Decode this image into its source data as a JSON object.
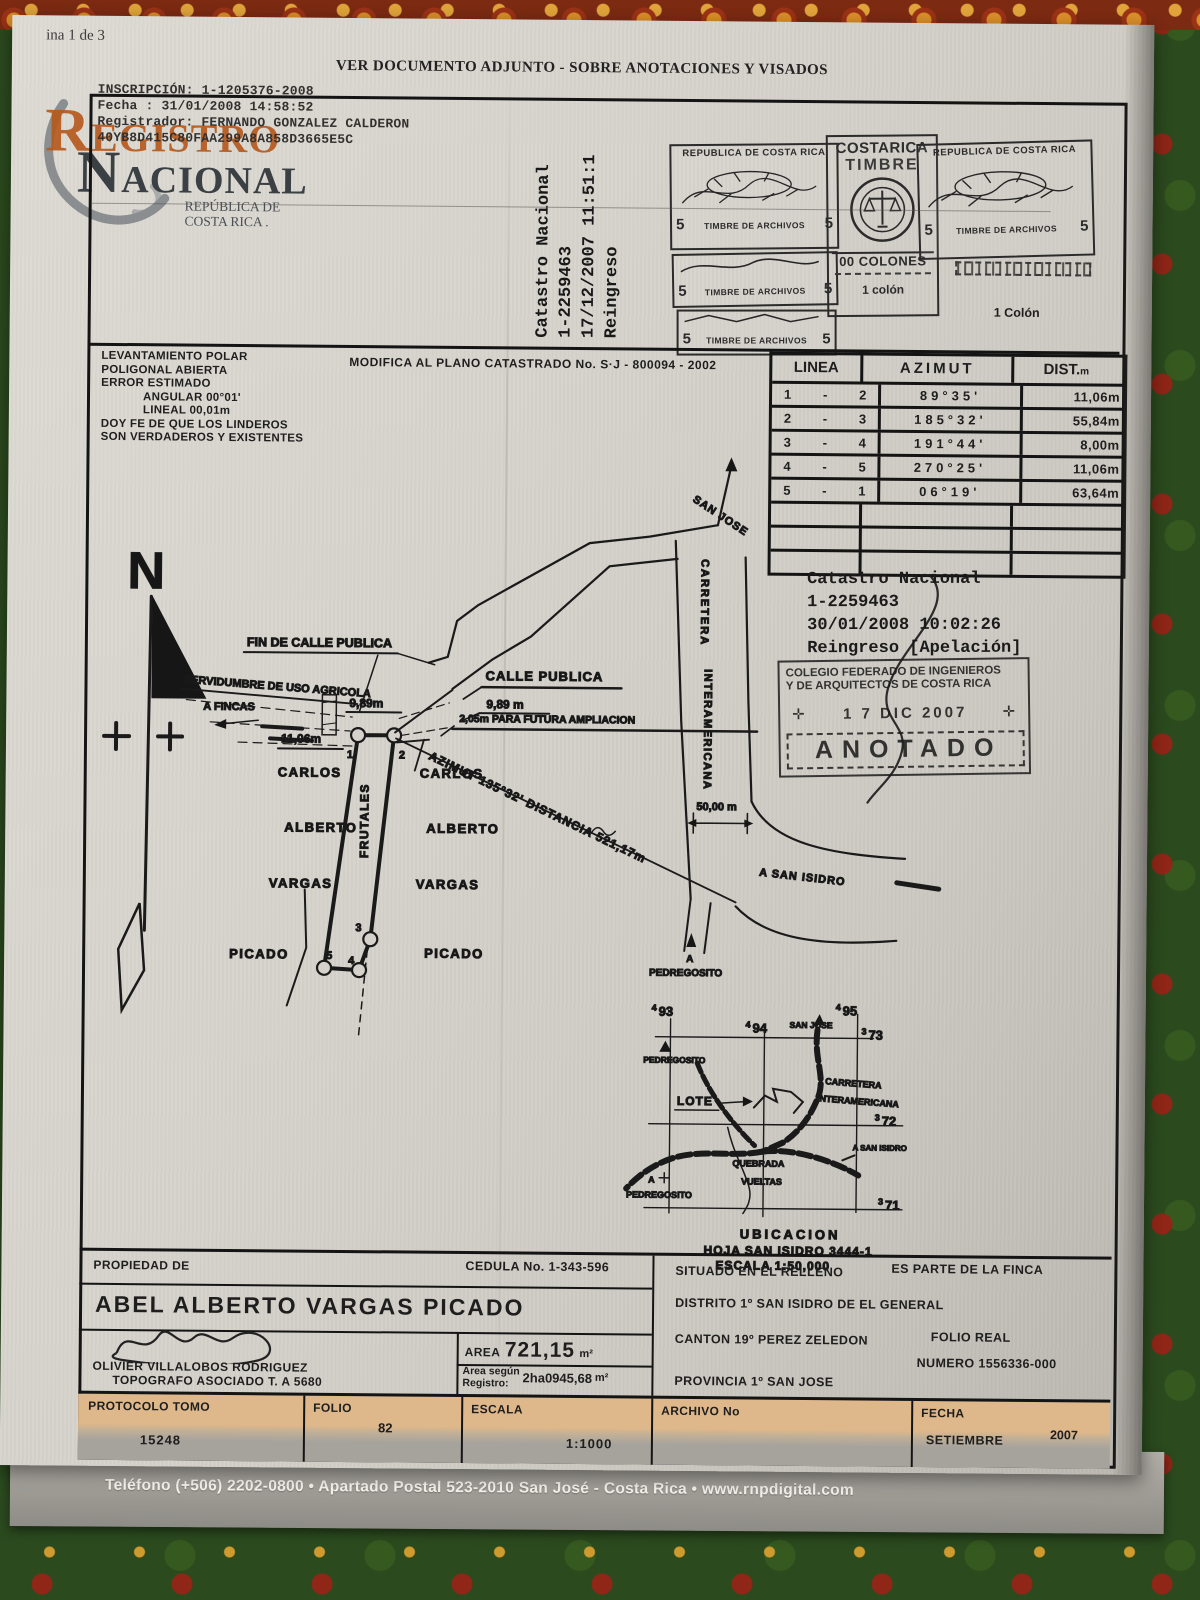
{
  "page": {
    "page_indicator": "ina 1 de 3",
    "header_title": "VER DOCUMENTO ADJUNTO - SOBRE ANOTACIONES Y VISADOS",
    "footer": "Teléfono (+506) 2202-0800 • Apartado Postal 523-2010 San José - Costa Rica • www.rnpdigital.com"
  },
  "inscription": {
    "line1": "INSCRIPCIÓN: 1-1205376-2008",
    "line2": "Fecha :  31/01/2008 14:58:52",
    "line3": "Registrador: FERNANDO GONZALEZ CALDERON",
    "line4": "40YB8D415C80FAA299A8A858D3665E5C"
  },
  "logo": {
    "registro": "REGISTRO",
    "nacional": "NACIONAL",
    "republica": "REPÚBLICA DE",
    "costa_rica": "COSTA RICA ."
  },
  "reingreso_vertical": {
    "line1": "Catastro Nacional",
    "line2": "1-2259463",
    "line3": "17/12/2007 11:51:1",
    "line4": "Reingreso"
  },
  "timbres": {
    "republica": "REPUBLICA DE COSTA RICA",
    "valor": "5",
    "timbre_archivos": "TIMBRE DE ARCHIVOS",
    "costarica": "COSTARICA",
    "timbre": "TIMBRE",
    "colones": "00 COLONES",
    "colon_small": "1 colón",
    "colon_cap": "1 Colón"
  },
  "notes": {
    "line1": "LEVANTAMIENTO  POLAR",
    "line2": "POLIGONAL  ABIERTA",
    "line3": "ERROR ESTIMADO",
    "line4": "ANGULAR 00°01'",
    "line5": "LINEAL    00,01m",
    "line6": "DOY FE DE QUE LOS LINDEROS",
    "line7": "SON VERDADEROS Y EXISTENTES"
  },
  "modifica": {
    "text": "MODIFICA AL PLANO CATASTRADO No. S·J - 800094 - 2002"
  },
  "table": {
    "col_linea": "LINEA",
    "col_azimut": "AZIMUT",
    "col_dist": "DIST.",
    "col_dist_unit": "m",
    "dash": "-",
    "rows": [
      {
        "from": "1",
        "to": "2",
        "azimut": "89°35'",
        "dist": "11,06m"
      },
      {
        "from": "2",
        "to": "3",
        "azimut": "185°32'",
        "dist": "55,84m"
      },
      {
        "from": "3",
        "to": "4",
        "azimut": "191°44'",
        "dist": "8,00m"
      },
      {
        "from": "4",
        "to": "5",
        "azimut": "270°25'",
        "dist": "11,06m"
      },
      {
        "from": "5",
        "to": "1",
        "azimut": "06°19'",
        "dist": "63,64m"
      }
    ]
  },
  "catastro_stamp": {
    "line1": "Catastro Nacional",
    "line2": "1-2259463",
    "line3": "30/01/2008 10:02:26",
    "line4": "Reingreso [Apelación]"
  },
  "anotado": {
    "line1": "COLEGIO FEDERADO DE INGENIEROS",
    "line2": "Y DE ARQUITECTOS DE COSTA RICA",
    "cross": "✛",
    "date": "1 7  DIC  2007",
    "word": "ANOTADO"
  },
  "drawing": {
    "north": "N",
    "fin_calle": "FIN DE CALLE PUBLICA",
    "servidumbre": "SERVIDUMBRE DE USO AGRICOLA",
    "a_fincas": "A FINCAS",
    "dim_989_left": "9,89m",
    "dim_1106": "11,06m",
    "calle_publica": "CALLE PUBLICA",
    "dim_989_right": "9,89 m",
    "ampliacion": "2,05m PARA FUTURA AMPLIACION",
    "azimut_label": "AZIMUT 135°32' DISTANCIA   521,17m",
    "frutales": "FRUTALES",
    "neighbor_left": [
      "CARLOS",
      "ALBERTO",
      "VARGAS",
      "PICADO"
    ],
    "neighbor_right": [
      "CARLOS",
      "ALBERTO",
      "VARGAS",
      "PICADO"
    ],
    "points": [
      "1",
      "2",
      "3",
      "4",
      "5"
    ],
    "san_jose": "SAN JOSE",
    "carretera": "CARRETERA",
    "interamericana": "INTERAMERICANA",
    "dim_50": "50,00 m",
    "a_san_isidro": "A SAN ISIDRO",
    "a": "A",
    "pedregosito": "PEDREGOSITO"
  },
  "map": {
    "g93p": "4",
    "g93": "93",
    "g94p": "4",
    "g94": "94",
    "g95p": "4",
    "g95": "95",
    "g73p": "3",
    "g73": "73",
    "g72p": "3",
    "g72": "72",
    "g71p": "3",
    "g71": "71",
    "pedregosito": "PEDREGOSITO",
    "san_jose": "SAN JOSE",
    "carretera": "CARRETERA",
    "interamericana": "INTERAMERICANA",
    "lote": "LOTE",
    "a_san_isidro": "A SAN ISIDRO",
    "quebrada": "QUEBRADA",
    "vueltas": "VUELTAS",
    "a": "A",
    "a_pedregosito": "PEDREGOSITO",
    "title": "UBICACION",
    "hoja": "HOJA SAN ISIDRO  3444-1",
    "escala": "ESCALA 1:50,000"
  },
  "property": {
    "propiedad_de": "PROPIEDAD DE",
    "owner": "ABEL  ALBERTO VARGAS PICADO",
    "cedula": "CEDULA No. 1-343-596",
    "situado": "SITUADO EN EL RELLENO",
    "es_parte": "ES PARTE DE LA FINCA",
    "distrito": "DISTRITO 1º SAN ISIDRO DE EL GENERAL",
    "canton": "CANTON 19º PEREZ ZELEDON",
    "folio_real": "FOLIO REAL",
    "folio_real_num": "NUMERO 1556336-000",
    "provincia": "PROVINCIA 1º SAN JOSE",
    "surveyor": "OLIVIER  VILLALOBOS RODRIGUEZ",
    "surveyor_title": "TOPOGRAFO  ASOCIADO   T. A 5680",
    "area_label": "AREA",
    "area_value": "721,15",
    "area_unit": "m²",
    "area_reg_label1": "Area según",
    "area_reg_label2": "Registro:",
    "area_reg_value": "2ha0945,68",
    "area_reg_unit": "m²",
    "protocolo_label": "PROTOCOLO TOMO",
    "protocolo": "15248",
    "folio_label": "FOLIO",
    "folio": "82",
    "escala_label": "ESCALA",
    "escala": "1:1000",
    "archivo_label": "ARCHIVO No",
    "fecha_label": "FECHA",
    "fecha_month": "SETIEMBRE",
    "fecha_year": "2007"
  }
}
